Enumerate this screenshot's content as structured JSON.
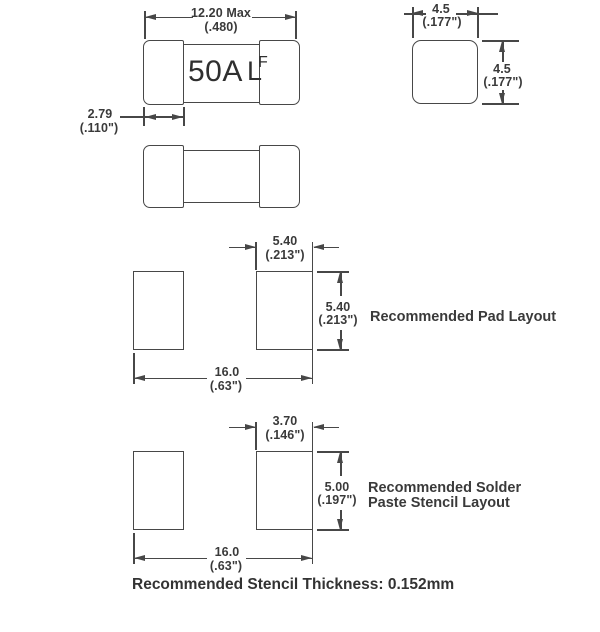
{
  "fuse_top_view": {
    "rating": "50A",
    "logo_l": "L",
    "logo_f": "F",
    "length_mm": "12.20 Max",
    "length_in": "(.480)",
    "terminal_mm": "2.79",
    "terminal_in": "(.110\")"
  },
  "end_view": {
    "width_mm": "4.5",
    "width_in": "(.177\")",
    "height_mm": "4.5",
    "height_in": "(.177\")"
  },
  "pad_layout": {
    "label": "Recommended Pad Layout",
    "pad_width_mm": "5.40",
    "pad_width_in": "(.213\")",
    "pad_height_mm": "5.40",
    "pad_height_in": "(.213\")",
    "span_mm": "16.0",
    "span_in": "(.63\")"
  },
  "stencil_layout": {
    "label_line1": "Recommended Solder",
    "label_line2": "Paste Stencil Layout",
    "opening_width_mm": "3.70",
    "opening_width_in": "(.146\")",
    "opening_height_mm": "5.00",
    "opening_height_in": "(.197\")",
    "span_mm": "16.0",
    "span_in": "(.63\")"
  },
  "footer": {
    "note": "Recommended Stencil Thickness: 0.152mm"
  },
  "colors": {
    "line": "#474747",
    "text": "#3a3a3a"
  }
}
